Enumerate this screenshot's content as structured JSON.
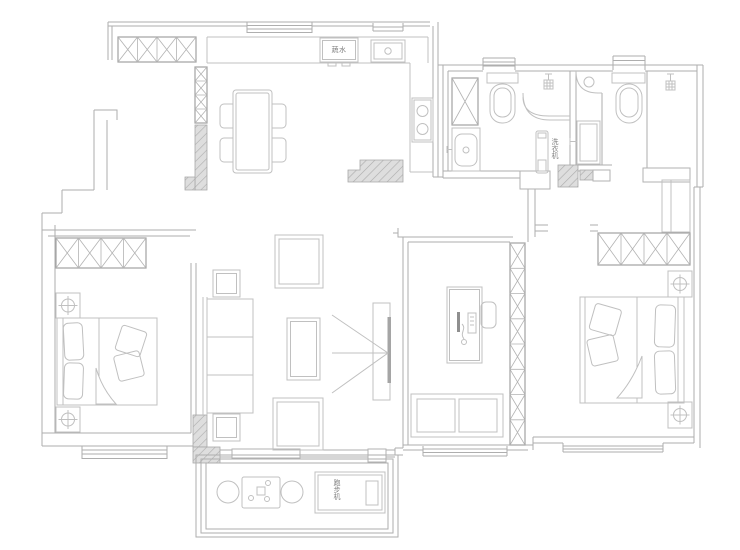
{
  "labels": {
    "kitchen_appliance": "蔬水",
    "washing_machine": "洗衣机",
    "treadmill": "跑步机"
  },
  "colors": {
    "line": "#aeaeae",
    "furniture_line": "#c0c0c0",
    "hatch_fill": "#dedede",
    "text": "#7f7f7f",
    "background": "#ffffff"
  }
}
